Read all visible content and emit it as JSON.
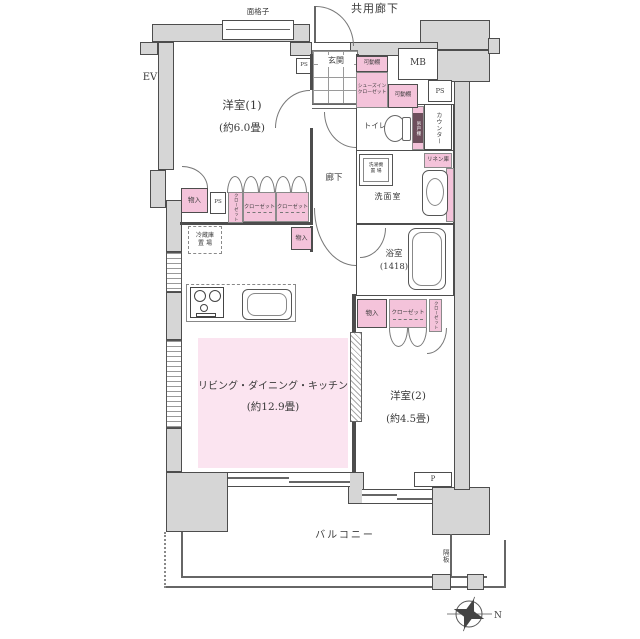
{
  "plan": {
    "title": "マンション間取り図",
    "colors": {
      "wall_fill": "#d6d6d6",
      "wall_border": "#4d4d4d",
      "closet_pink": "#f4c3da",
      "ldk_pink": "#fbe4f0",
      "line": "#666666",
      "text": "#3a3a3a"
    },
    "exterior": {
      "common_corridor": "共用廊下",
      "lattice": "面格子",
      "elevator": "EV",
      "balcony": "バルコニー",
      "partition": "隔板",
      "north": "N"
    },
    "rooms": {
      "room1": {
        "name": "洋室(1)",
        "size": "(約6.0畳)"
      },
      "room2": {
        "name": "洋室(2)",
        "size": "(約4.5畳)"
      },
      "ldk": {
        "name": "リビング・ダイニング・キッチン",
        "size": "(約12.9畳)"
      },
      "bathroom": {
        "name": "浴室",
        "size": "(1418)"
      },
      "washroom": {
        "name": "洗面室"
      },
      "toilet": {
        "name": "トイレ"
      },
      "entrance": {
        "name": "玄関"
      },
      "corridor": {
        "name": "廊下"
      }
    },
    "storage": {
      "closet": "クローゼット",
      "shoes_closet_line1": "シューズイン",
      "shoes_closet_line2": "クローゼット",
      "movable_shelf": "可動棚",
      "storage": "物入",
      "linen": "リネン庫",
      "hanging_shelf": "吊戸棚",
      "counter": "カウンター",
      "fridge_line1": "冷蔵庫",
      "fridge_line2": "置 場",
      "washer_line1": "洗濯機",
      "washer_line2": "置 場"
    },
    "service": {
      "ps": "PS",
      "mb": "MB",
      "p": "P"
    }
  }
}
